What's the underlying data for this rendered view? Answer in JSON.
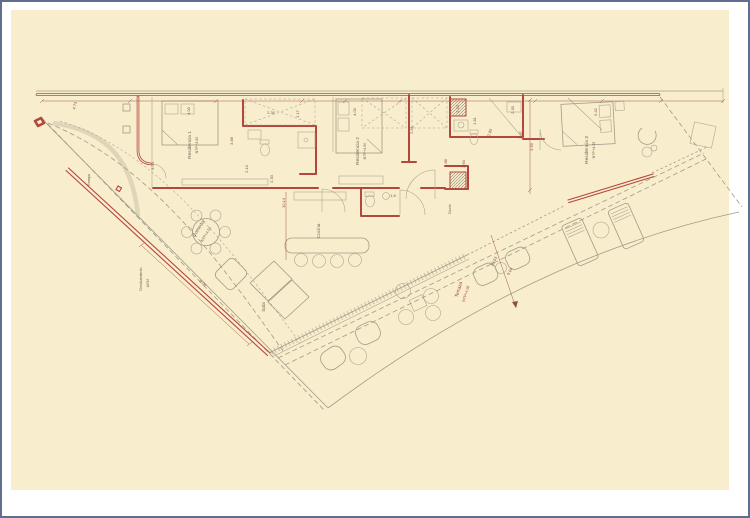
{
  "sheet": {
    "background": "#f8eecd",
    "frame_color": "#5f6e8e"
  },
  "colors": {
    "wall_red": "#b4473d",
    "line_grey": "#a39b88",
    "text_grey": "#6f6757",
    "text_red": "#a63d2f",
    "dim_red": "#8a5146"
  },
  "rooms": [
    {
      "name": "Residencia 1",
      "level": "NTP+4.50"
    },
    {
      "name": "Residencia 2",
      "level": "NTP+4.50"
    },
    {
      "name": "Residencia 3",
      "level": "NTP+4.35"
    },
    {
      "name": "Cocina",
      "level": ""
    },
    {
      "name": "Comedor",
      "level": "NTP+4.50"
    },
    {
      "name": "Sala",
      "level": ""
    },
    {
      "name": "Terraza",
      "level": "NTP+4.26"
    },
    {
      "name": "Ducto",
      "level": ""
    },
    {
      "name": "Rampa",
      "level": ""
    },
    {
      "name": "Deslizamiento",
      "level": "A052"
    }
  ],
  "dimensions": [
    "4.73",
    "4.00",
    "3.34",
    "3.88",
    "2.10",
    "2.30",
    "1.17",
    "10.14",
    "4.00",
    "2.81",
    "2.30",
    "1.81",
    "2.30",
    "2.80",
    "3.87",
    "1.88",
    "2.60",
    "1.5",
    "5.42",
    "3.99",
    "19.53",
    "9.04",
    "8.00",
    "2.30"
  ]
}
